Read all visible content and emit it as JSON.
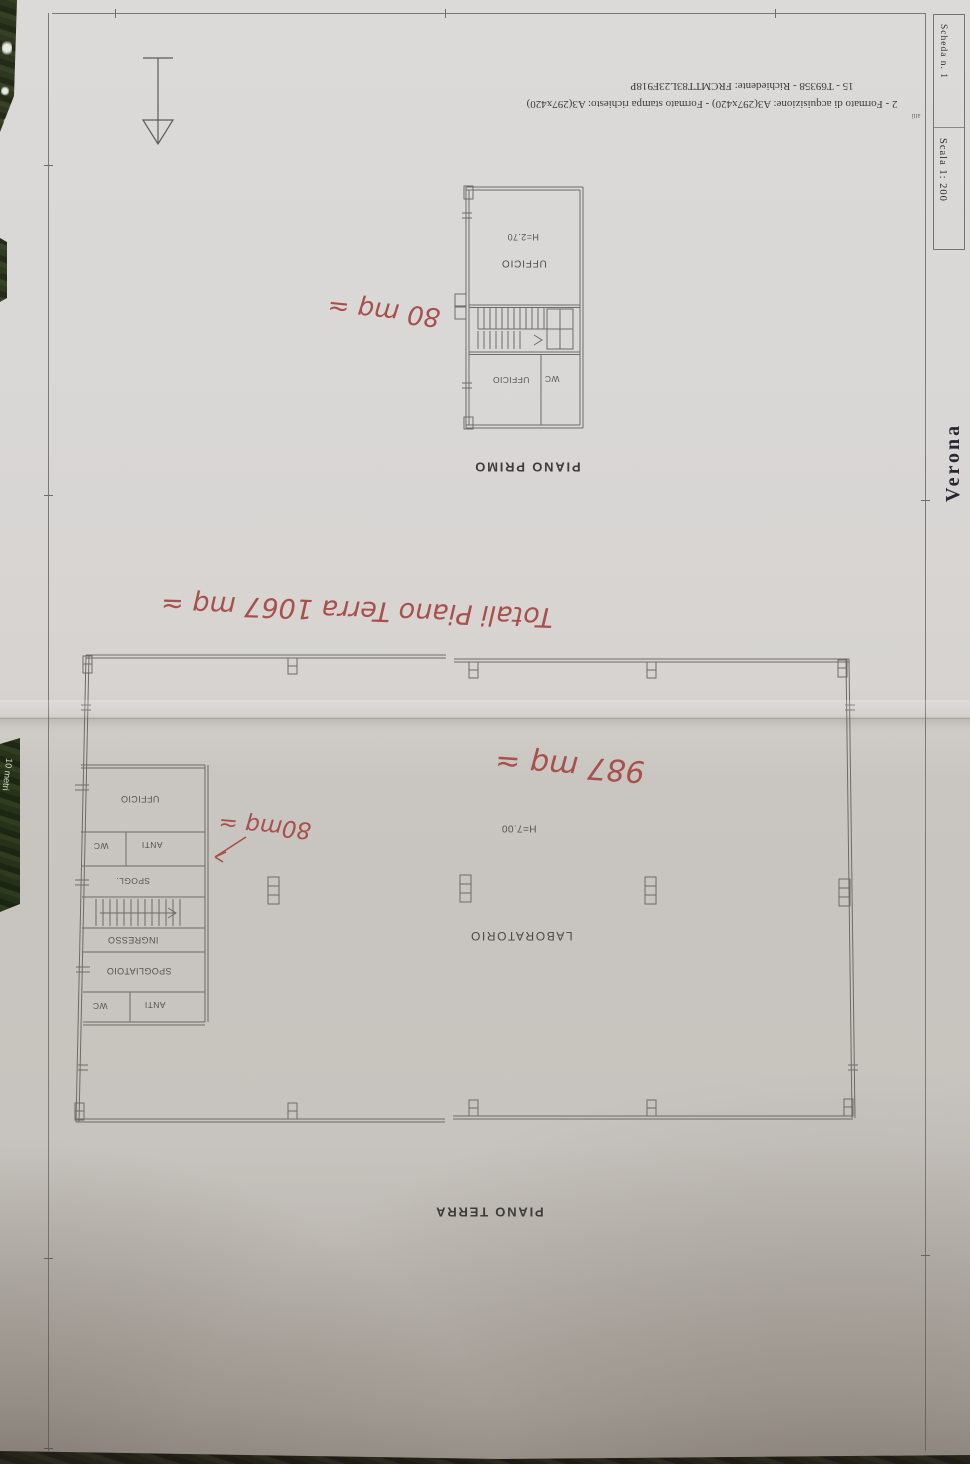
{
  "photo": {
    "ruler_label": "10 metri"
  },
  "title_block": {
    "line1": "15 - T69358 - Richiedente: FRCMTT83L23F918P",
    "line2": "2 - Formato di acquisizione: A3(297x420) - Formato stampa richiesto: A3(297x420)",
    "line3": "atti",
    "sheet_no": "Scheda n. 1",
    "scale": "Scala 1: 200",
    "stamp": "Verona"
  },
  "piano_primo": {
    "label": "PIANO PRIMO",
    "room_ufficio": "UFFICIO",
    "room_height": "H=2.70",
    "room_wc": "WC",
    "room_ufficio2": "UFFICIO",
    "note_area": "80 mq ≃"
  },
  "piano_terra": {
    "label": "PIANO TERRA",
    "room_laboratorio": "LABORATORIO",
    "room_height": "H=7.00",
    "wing": {
      "ufficio": "UFFICIO",
      "wc1": "WC",
      "anti1": "ANTI",
      "spogl": "SPOGL.",
      "ingresso": "INGRESSO",
      "spogliatoio": "SPOGLIATOIO",
      "wc2": "WC",
      "anti2": "ANTI"
    },
    "note_wing": "80mq ≃",
    "note_lab": "987 mq ≃",
    "note_total": "Totali Piano Terra  1067 mq ≃"
  },
  "colors": {
    "ink_red": "#a8504c",
    "plan_line": "#6e6c68",
    "paper": "#d6d3d0",
    "background_green": "#243018"
  }
}
